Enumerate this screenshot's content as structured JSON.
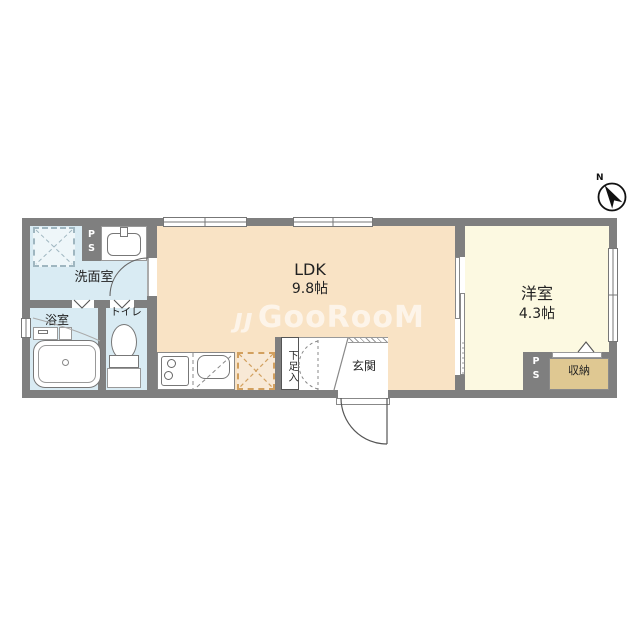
{
  "watermark": {
    "logo": "ȷȷ",
    "text": "GooRooM"
  },
  "compass": {
    "label": "N"
  },
  "rooms": {
    "ldk": {
      "name": "LDK",
      "area": "9.8帖"
    },
    "western_room": {
      "name": "洋室",
      "area": "4.3帖"
    },
    "washroom": {
      "name": "洗面室"
    },
    "bathroom": {
      "name": "浴室"
    },
    "toilet": {
      "name": "トイレ"
    },
    "entrance": {
      "name": "玄関"
    },
    "shoe_cabinet": {
      "name": "下足入"
    },
    "storage": {
      "name": "収納"
    }
  },
  "pipe_space": {
    "letter_top": "P",
    "letter_bottom": "S"
  },
  "colors": {
    "wall": "#7f7f7f",
    "ldk_floor": "#f9e3c5",
    "western_floor": "#fcf9e1",
    "wet_area_floor": "#d9ebf3",
    "storage_floor": "#dfc892",
    "fridge_space_fill": "#f8e9d6",
    "fridge_space_dash": "#d2a05f"
  }
}
